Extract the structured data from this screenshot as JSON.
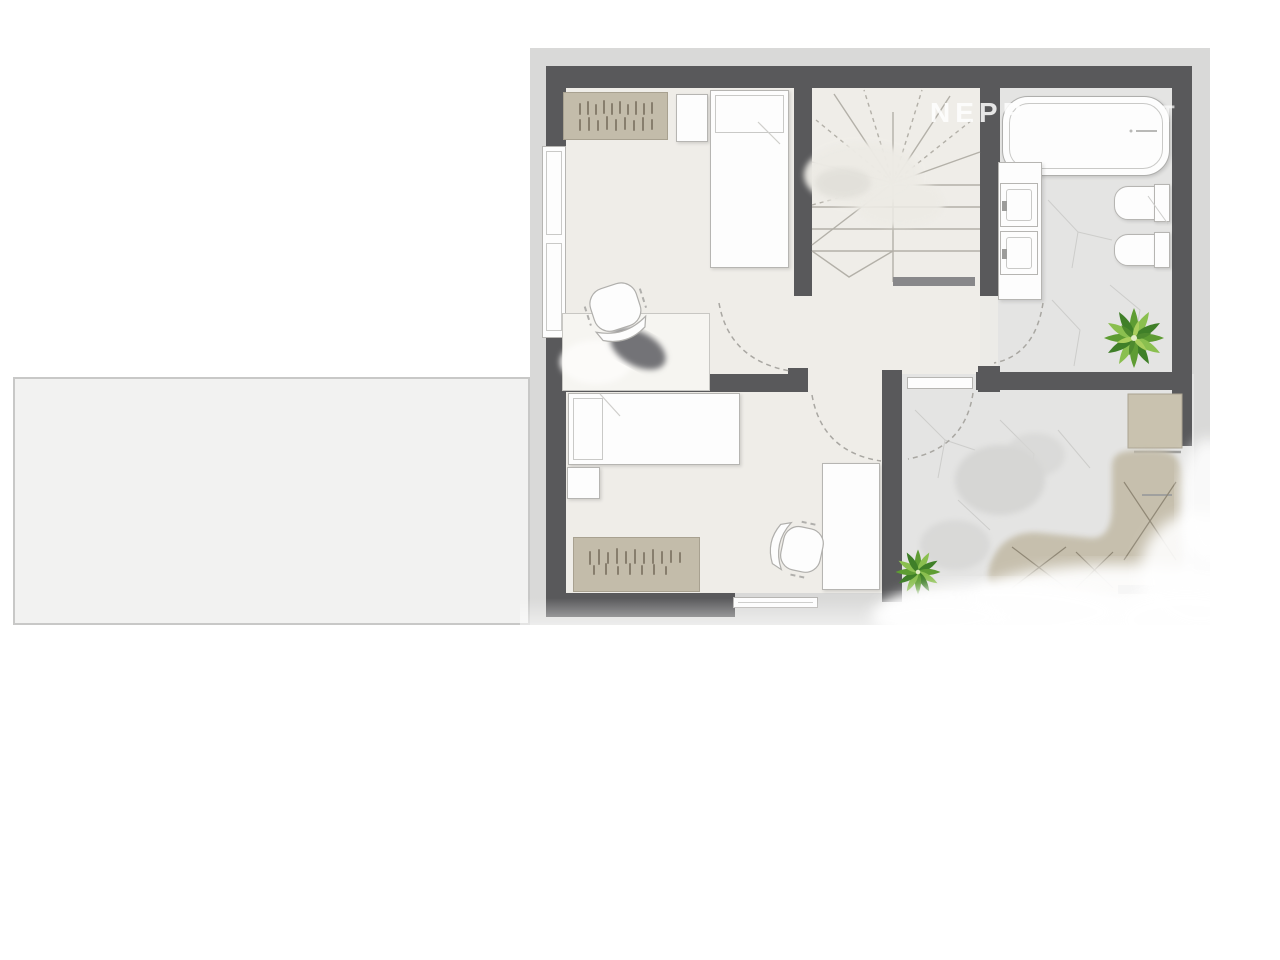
{
  "meta": {
    "type": "architectural-floor-plan",
    "floor": "upper-floor",
    "rooms_visible": [
      "bedroom-top",
      "bedroom-bottom",
      "stair-hall",
      "bathroom",
      "landing"
    ],
    "text_labels_visible": false
  },
  "watermark": {
    "part1": "NEPP",
    "part2": "T"
  },
  "colors": {
    "background": "#ffffff",
    "wall": "#59595b",
    "exterior_band": "#d9d9d8",
    "room_floor": "#efede8",
    "tile_floor": "#e4e4e3",
    "furniture_white": "#fdfdfd",
    "furniture_tan": "#c3bcaa",
    "plant_green": "#5e9c33",
    "roof_slab": "#f2f2f1"
  },
  "objects": {
    "beds": 2,
    "desks": 2,
    "chairs": 2,
    "sideboards": 2,
    "nightstands": 2,
    "bathtub": 1,
    "sinks": 2,
    "toilet": 1,
    "bidet": 1,
    "plants": 2,
    "staircase": 1,
    "door_arcs": 4,
    "windows": 3,
    "wardrobe_units": 1
  }
}
